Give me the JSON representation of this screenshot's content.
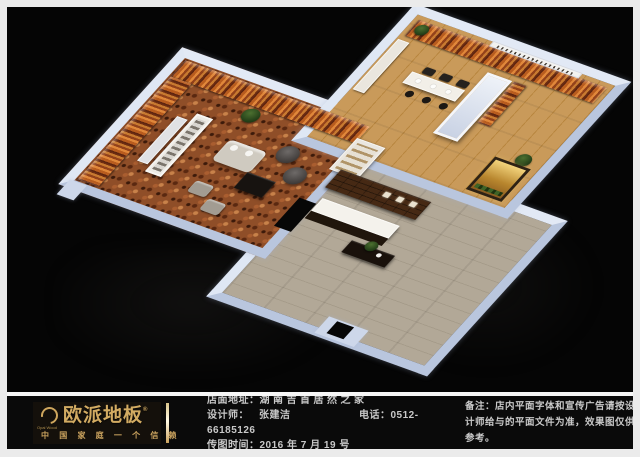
{
  "frame": {
    "border_color": "#ebebeb",
    "stage_background": "#050505"
  },
  "floorplan": {
    "kind": "isometric 3D store floor-plan rendering",
    "palette": {
      "wall_top": "#ccd7eb",
      "display_panel_orange": "#c06a28",
      "showroom_left_floor_mosaic": "#8f4e28",
      "showroom_right_floor_wood": "#c2914f",
      "hall_floor_grey_wood": "#afa593",
      "feature_wall_brown": "#462914",
      "backlit_niche_gold": "#e8c76a"
    },
    "rooms": [
      {
        "id": "showroom-left",
        "floor": "mosaic-carpet",
        "contents": "wall flooring panels, display racks, sofa set, armchairs, coffee table, ottomans, plant"
      },
      {
        "id": "showroom-right",
        "floor": "wood-plank",
        "contents": "wall flooring panels, signage band, bar island with chairs and stools, white column, cabinets, plants, backlit niche"
      },
      {
        "id": "reception-hall",
        "floor": "grey-wood-plank",
        "contents": "brown feature wall with niches, white reception desk, black display table with plant, entrance"
      }
    ]
  },
  "footer": {
    "logo": {
      "brand": "欧派地板",
      "reg": "®",
      "latin": "Opai Wood",
      "slogan": "中 国 家 庭 一 个 信 赖",
      "accent_color": "#d2ab62"
    },
    "rows": {
      "address_label": "店面地址：",
      "address_value": "湖南吉首居然之家",
      "designer_label": "设计师：",
      "designer_value": "张建洁",
      "phone_label": "电话：",
      "phone_value": "0512-66185126",
      "date_label": "传图时间：",
      "date_value": "2016 年 7 月 19 号"
    },
    "note": {
      "label": "备注：",
      "text": "店内平面字体和宣传广告请按设计师给与的平面文件为准，效果图仅供参考。"
    }
  }
}
